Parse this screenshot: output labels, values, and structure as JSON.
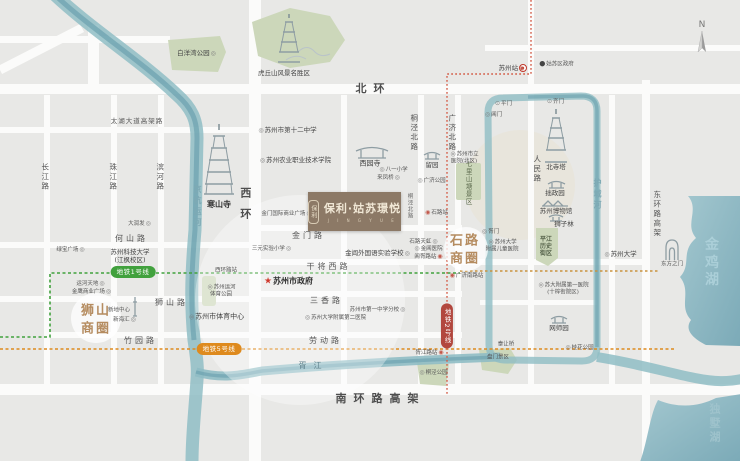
{
  "project": {
    "name": "保利·姑苏璟悦",
    "tagline": "J I N G Y U E",
    "emblem": "保利"
  },
  "compass": {
    "letter": "N"
  },
  "metro": {
    "line1": {
      "label": "地铁1号线",
      "color": "#41a13d"
    },
    "line5": {
      "label": "地铁5号线",
      "color": "#de8a1e"
    },
    "line2": {
      "label": "地铁2号线",
      "color": "#b2473e"
    }
  },
  "labels": [
    {
      "id": "road-beihuan",
      "t": "北环",
      "cls": "roadXL",
      "x": 370,
      "y": 89
    },
    {
      "id": "road-taihu-viaduct",
      "t": "太湖大道高架路",
      "cls": "roadS",
      "x": 137,
      "y": 121
    },
    {
      "id": "road-heshan",
      "t": "何山路",
      "cls": "road",
      "x": 130,
      "y": 239
    },
    {
      "id": "road-jinmen",
      "t": "金门路",
      "cls": "road",
      "x": 307,
      "y": 236
    },
    {
      "id": "road-ganjiang-w",
      "t": "干将西路",
      "cls": "road",
      "x": 327,
      "y": 267
    },
    {
      "id": "road-sanxiang",
      "t": "三香路",
      "cls": "road",
      "x": 325,
      "y": 301
    },
    {
      "id": "road-shishan",
      "t": "狮山路",
      "cls": "road",
      "x": 170,
      "y": 303
    },
    {
      "id": "road-zhuyuan",
      "t": "竹园路",
      "cls": "road",
      "x": 139,
      "y": 341
    },
    {
      "id": "road-laodong",
      "t": "劳动路",
      "cls": "road",
      "x": 324,
      "y": 341
    },
    {
      "id": "road-nanhuan-viaduct",
      "t": "南环路高架",
      "cls": "roadXL",
      "x": 377,
      "y": 399
    },
    {
      "id": "road-changjiang",
      "t": "长江路",
      "cls": "roadV",
      "x": 45,
      "y": 177
    },
    {
      "id": "road-zhujiang",
      "t": "珠江路",
      "cls": "roadV",
      "x": 113,
      "y": 177
    },
    {
      "id": "road-binhe",
      "t": "滨河路",
      "cls": "roadV",
      "x": 160,
      "y": 177
    },
    {
      "id": "road-xihuan",
      "t": "西环",
      "cls": "roadVXL",
      "x": 245,
      "y": 208
    },
    {
      "id": "road-tongjing-n",
      "t": "桐泾北路",
      "cls": "roadV",
      "x": 414,
      "y": 133
    },
    {
      "id": "road-guangji-n",
      "t": "广济北路",
      "cls": "roadV",
      "x": 452,
      "y": 133
    },
    {
      "id": "road-tongjing-n2",
      "t": "桐泾北路",
      "cls": "roadVs",
      "x": 409,
      "y": 206
    },
    {
      "id": "road-renmin",
      "t": "人民路",
      "cls": "roadV",
      "x": 537,
      "y": 169
    },
    {
      "id": "water-moat",
      "t": "护城河",
      "cls": "waterV",
      "x": 597,
      "y": 195
    },
    {
      "id": "road-donghuan-viaduct",
      "t": "东环路高架",
      "cls": "roadV",
      "x": 657,
      "y": 214
    },
    {
      "id": "water-grand-canal",
      "t": "京杭运河",
      "cls": "waterV",
      "x": 197,
      "y": 207
    },
    {
      "id": "water-jinji-lake",
      "t": "金鸡湖",
      "cls": "waterXL",
      "x": 714,
      "y": 263
    },
    {
      "id": "water-dushu-lake",
      "t": "独墅湖",
      "cls": "waterL",
      "x": 716,
      "y": 423
    },
    {
      "id": "water-xujiang",
      "t": "胥江",
      "cls": "waterS",
      "x": 310,
      "y": 366
    },
    {
      "id": "district-shishan",
      "t": "狮山\n商圈",
      "cls": "district",
      "x": 96,
      "y": 320
    },
    {
      "id": "district-shilu",
      "t": "石路\n商圈",
      "cls": "district",
      "x": 465,
      "y": 250
    },
    {
      "id": "poi-baiyangwan-park",
      "t": "白洋湾公园",
      "cls": "poiS",
      "post": "◎",
      "x": 197,
      "y": 53
    },
    {
      "id": "poi-huqiu-scenic",
      "t": "虎丘山风景名胜区",
      "cls": "poiS",
      "x": 284,
      "y": 73
    },
    {
      "id": "poi-no12-school",
      "t": "苏州市第十二中学",
      "cls": "poiS",
      "pre": "◎",
      "x": 287,
      "y": 130
    },
    {
      "id": "poi-hanshan-temple",
      "t": "寒山寺",
      "cls": "poiB",
      "x": 219,
      "y": 205
    },
    {
      "id": "poi-darunfa",
      "t": "大润发",
      "cls": "poiXS",
      "post": "◎",
      "x": 140,
      "y": 224
    },
    {
      "id": "poi-lvbao-plaza",
      "t": "绿宝广场",
      "cls": "poiXS",
      "post": "◎",
      "x": 71,
      "y": 250
    },
    {
      "id": "poi-keji-university",
      "t": "苏州科技大学\n(江枫校区)",
      "cls": "poiS",
      "x": 130,
      "y": 256
    },
    {
      "id": "poi-nongye-college",
      "t": "苏州农业职业技术学院",
      "cls": "poiS",
      "pre": "◎",
      "x": 295,
      "y": 160
    },
    {
      "id": "poi-xiyuan-temple",
      "t": "西园寺",
      "cls": "poi",
      "x": 370,
      "y": 164
    },
    {
      "id": "poi-bayi-school",
      "t": "八一小学",
      "cls": "poiXS",
      "pre": "◎",
      "x": 393,
      "y": 170
    },
    {
      "id": "poi-laifengqiao",
      "t": "来凤桥",
      "cls": "poiXS",
      "post": "◎",
      "x": 389,
      "y": 178
    },
    {
      "id": "poi-liuyuan-garden",
      "t": "留园",
      "cls": "poiS",
      "x": 432,
      "y": 165
    },
    {
      "id": "poi-guangji-park",
      "t": "广济公园",
      "cls": "poiXS",
      "pre": "◎",
      "x": 431,
      "y": 181
    },
    {
      "id": "poi-shili-hospital",
      "t": "苏州市立\n医院(北区)",
      "cls": "poiXS",
      "pre": "◎",
      "x": 464,
      "y": 158
    },
    {
      "id": "poi-qilishantang",
      "t": "七里山塘景区",
      "cls": "parkV",
      "x": 468,
      "y": 183
    },
    {
      "id": "poi-suzhou-station",
      "t": "苏州站",
      "cls": "poiS",
      "post": "◉",
      "postCls": "red",
      "x": 512,
      "y": 68
    },
    {
      "id": "poi-gusu-government",
      "t": "姑苏区政府",
      "cls": "poiXS",
      "pre": "●",
      "preCls": "dot",
      "x": 556,
      "y": 64
    },
    {
      "id": "poi-pingmen-gate",
      "t": "平门",
      "cls": "poiXS",
      "pre": "⊙",
      "x": 503,
      "y": 104
    },
    {
      "id": "poi-qimen-gate",
      "t": "齐门",
      "cls": "poiXS",
      "pre": "⊙",
      "x": 555,
      "y": 102
    },
    {
      "id": "poi-changmen-gate",
      "t": "阊门",
      "cls": "poiXS",
      "pre": "◎",
      "x": 493,
      "y": 115
    },
    {
      "id": "poi-beisita-pagoda",
      "t": "北寺塔",
      "cls": "poiS",
      "x": 556,
      "y": 167
    },
    {
      "id": "poi-zhuozhengyuan",
      "t": "拙政园",
      "cls": "poiS",
      "x": 555,
      "y": 193
    },
    {
      "id": "poi-suzhou-museum",
      "t": "苏州博物馆",
      "cls": "poiS",
      "x": 556,
      "y": 211
    },
    {
      "id": "poi-shizilin",
      "t": "狮子林",
      "cls": "poiS",
      "x": 564,
      "y": 224
    },
    {
      "id": "poi-jinmen-plaza",
      "t": "金门国际商业广场",
      "cls": "poiXS",
      "post": "◎",
      "x": 287,
      "y": 214
    },
    {
      "id": "poi-sanyuan-school",
      "t": "三元实验小学",
      "cls": "poiXS",
      "post": "◎",
      "x": 272,
      "y": 249
    },
    {
      "id": "poi-jinchang-school",
      "t": "金阊外国语实验学校",
      "cls": "poiS",
      "post": "◎",
      "x": 378,
      "y": 253
    },
    {
      "id": "poi-shilu-tianhong",
      "t": "石路天虹",
      "cls": "poiXS",
      "post": "◎",
      "x": 424,
      "y": 242
    },
    {
      "id": "poi-jinchang-hospital",
      "t": "金阊医院",
      "cls": "poiXS",
      "pre": "◎",
      "x": 428,
      "y": 249
    },
    {
      "id": "station-changxulu",
      "t": "阊胥路站",
      "cls": "poiXS",
      "post": "◉",
      "postCls": "red",
      "x": 429,
      "y": 257
    },
    {
      "id": "station-shilu",
      "t": "石路站",
      "cls": "poiXS",
      "pre": "◉",
      "preCls": "red",
      "x": 436,
      "y": 213
    },
    {
      "id": "station-guangjinanlu",
      "t": "广济南路站",
      "cls": "poiXS",
      "pre": "◉",
      "preCls": "red",
      "x": 466,
      "y": 276
    },
    {
      "id": "station-xihuanlu",
      "t": "西环路站",
      "cls": "poiXS",
      "x": 226,
      "y": 271
    },
    {
      "id": "poi-yunhe-sport-park",
      "t": "苏州运河\n体育公园",
      "cls": "poiXS",
      "pre": "◎",
      "x": 221,
      "y": 291
    },
    {
      "id": "poi-sport-center",
      "t": "苏州市体育中心",
      "cls": "poi",
      "pre": "◎",
      "x": 216,
      "y": 317
    },
    {
      "id": "poi-xindi-center",
      "t": "新地中心",
      "cls": "poiXS",
      "x": 119,
      "y": 311
    },
    {
      "id": "poi-xinhaihui",
      "t": "新海汇",
      "cls": "poiXS",
      "post": "◎",
      "x": 125,
      "y": 320
    },
    {
      "id": "poi-yunhe-tiandi",
      "t": "运河天地",
      "cls": "poiXS",
      "post": "◎",
      "x": 91,
      "y": 284
    },
    {
      "id": "poi-jinying-plaza",
      "t": "金鹰商业广场",
      "cls": "poiXS",
      "post": "◎",
      "x": 92,
      "y": 292
    },
    {
      "id": "poi-city-government",
      "t": "苏州市政府",
      "cls": "poiB",
      "pre": "★",
      "preCls": "star",
      "x": 288,
      "y": 282
    },
    {
      "id": "poi-no1-school",
      "t": "苏州市第一中学分校",
      "cls": "poiXS",
      "post": "◎",
      "x": 378,
      "y": 310
    },
    {
      "id": "poi-fuer-hospital",
      "t": "苏州大学附属第二医院",
      "cls": "poiXS",
      "pre": "◎",
      "x": 335,
      "y": 318
    },
    {
      "id": "station-xujianglu",
      "t": "胥江路站",
      "cls": "poiXS",
      "post": "◉",
      "postCls": "red",
      "x": 430,
      "y": 353
    },
    {
      "id": "poi-tongjing-park",
      "t": "桐泾公园",
      "cls": "poiXS",
      "pre": "◎",
      "x": 433,
      "y": 373
    },
    {
      "id": "poi-tairang-bridge",
      "t": "泰让桥",
      "cls": "poiXS",
      "x": 506,
      "y": 345
    },
    {
      "id": "poi-panmen-scenic",
      "t": "盘门景区",
      "cls": "poiXS",
      "x": 498,
      "y": 358
    },
    {
      "id": "poi-xumen-gate",
      "t": "胥门",
      "cls": "poiXS",
      "pre": "◎",
      "x": 490,
      "y": 232
    },
    {
      "id": "poi-children-hospital",
      "t": "苏州大学\n附属儿童医院",
      "cls": "poiXS",
      "pre": "◎",
      "x": 502,
      "y": 246
    },
    {
      "id": "poi-pingjiang-district",
      "t": "平江\n历史\n街区",
      "cls": "parkBlock",
      "x": 546,
      "y": 247
    },
    {
      "id": "poi-suzhou-university",
      "t": "苏州大学",
      "cls": "poiS",
      "pre": "◎",
      "x": 620,
      "y": 254
    },
    {
      "id": "poi-gate-of-the-east",
      "t": "东方之门",
      "cls": "poiXS",
      "x": 672,
      "y": 265
    },
    {
      "id": "poi-fuyi-hospital",
      "t": "苏大附属第一医院\n(十梓街院区)",
      "cls": "poiXS",
      "pre": "◎",
      "x": 563,
      "y": 289
    },
    {
      "id": "poi-wangshiyuan",
      "t": "网师园",
      "cls": "poiS",
      "x": 559,
      "y": 328
    },
    {
      "id": "poi-guihua-park",
      "t": "桂花公园",
      "cls": "poiXS",
      "pre": "◎",
      "x": 579,
      "y": 348
    },
    {
      "id": "badge-metro-line1",
      "t": "地铁1号线",
      "cls": "pill1",
      "x": 133,
      "y": 272
    },
    {
      "id": "badge-metro-line5",
      "t": "地铁5号线",
      "cls": "pill5",
      "x": 219,
      "y": 349
    },
    {
      "id": "badge-metro-line2",
      "t": "地铁2号线",
      "cls": "pill2v",
      "x": 447,
      "y": 326
    }
  ]
}
